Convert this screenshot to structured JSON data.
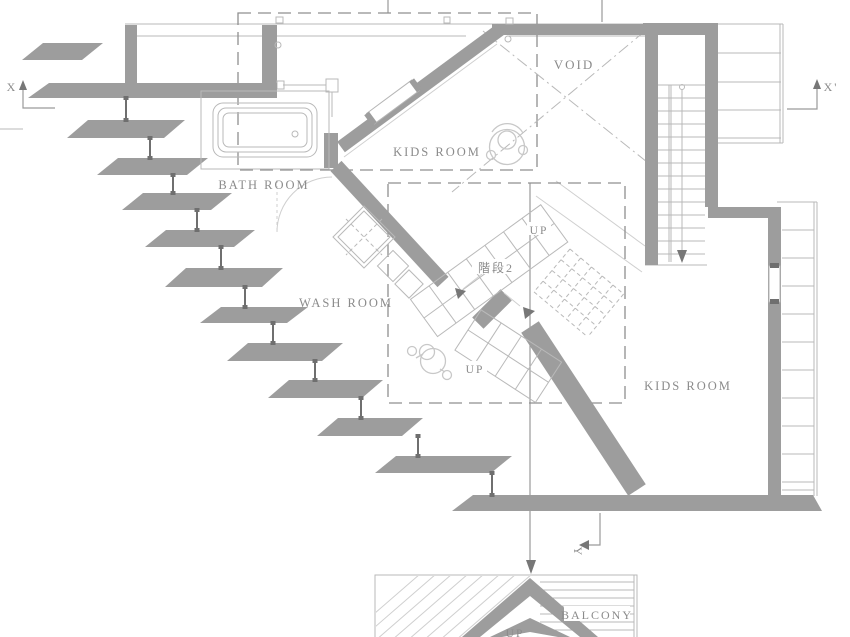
{
  "colors": {
    "wall": "#9d9d9d",
    "wall_dark": "#6f6f6f",
    "line": "#b9b9b9",
    "line_light": "#cfcfcf",
    "dash": "#8f8f8f",
    "text": "#8b8b8b",
    "figure": "#c8c8c8"
  },
  "labels": {
    "void": "VOID",
    "kids_room_upper": "KIDS ROOM",
    "kids_room_lower": "KIDS ROOM",
    "bath_room": "BATH ROOM",
    "wash_room": "WASH ROOM",
    "stair2": "階段2",
    "up_upper": "UP",
    "up_lower": "UP",
    "up_balcony": "UP",
    "balcony": "BALCONY"
  },
  "section_markers": {
    "x": "X",
    "x_prime": "X'",
    "y": "Y"
  }
}
